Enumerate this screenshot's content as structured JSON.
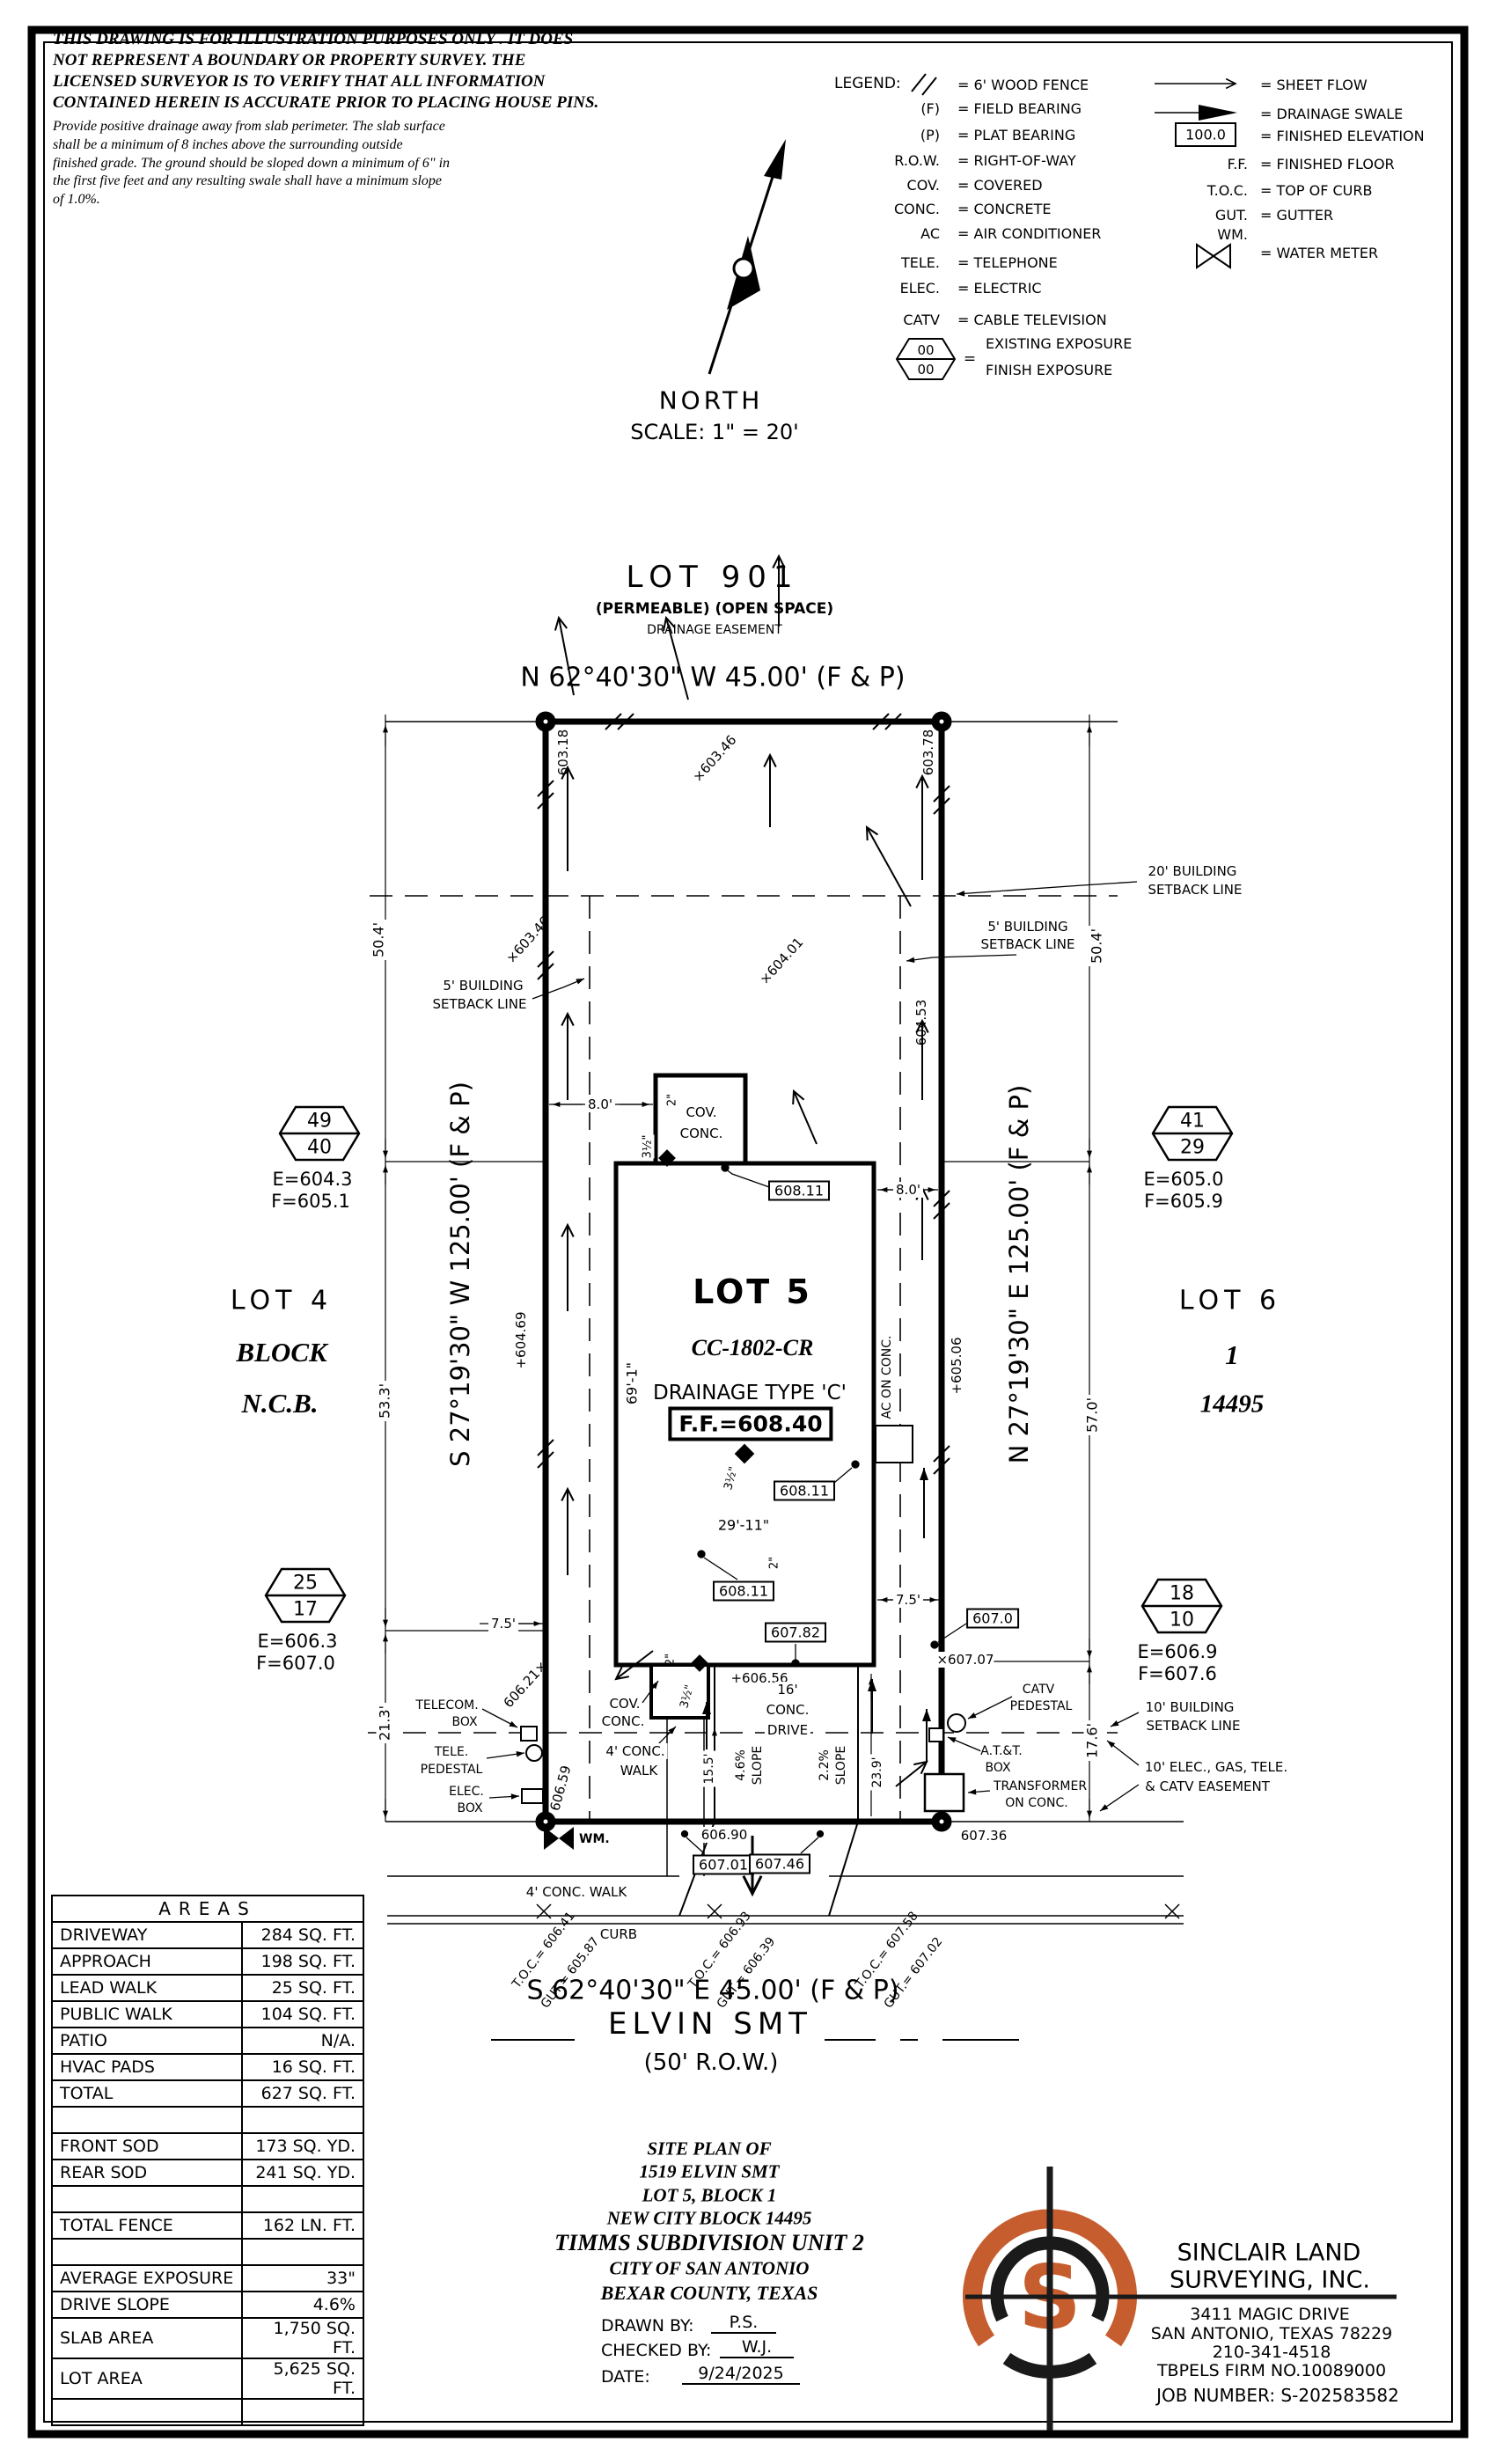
{
  "disclaimer": {
    "l1": "THIS DRAWING IS FOR ILLUSTRATION PURPOSES ONLY . IT DOES",
    "l2": "NOT REPRESENT A BOUNDARY OR PROPERTY SURVEY. THE",
    "l3": "LICENSED SURVEYOR IS TO VERIFY THAT ALL INFORMATION",
    "l4": "CONTAINED HEREIN IS ACCURATE PRIOR TO PLACING HOUSE PINS.",
    "note": "Provide positive drainage away from slab perimeter. The slab surface shall be a minimum of 8 inches above the surrounding outside finished grade. The ground should be sloped down a minimum of 6\" in the first five feet and any resulting swale shall have a minimum slope of 1.0%."
  },
  "legend": {
    "title": "LEGEND:",
    "eq": "=",
    "fence_def": "= 6' WOOD FENCE",
    "rows_left": [
      {
        "sym": "(F)",
        "def": "= FIELD BEARING"
      },
      {
        "sym": "(P)",
        "def": "= PLAT BEARING"
      },
      {
        "sym": "R.O.W.",
        "def": "= RIGHT-OF-WAY"
      },
      {
        "sym": "COV.",
        "def": "= COVERED"
      },
      {
        "sym": "CONC.",
        "def": "= CONCRETE"
      },
      {
        "sym": "AC",
        "def": "= AIR CONDITIONER"
      },
      {
        "sym": "TELE.",
        "def": "= TELEPHONE"
      },
      {
        "sym": "ELEC.",
        "def": "= ELECTRIC"
      },
      {
        "sym": "CATV",
        "def": "= CABLE TELEVISION"
      }
    ],
    "exposure": {
      "top": "00",
      "bottom": "00",
      "def1": "EXISTING EXPOSURE",
      "def2": "FINISH EXPOSURE"
    },
    "sheet_flow": "= SHEET FLOW",
    "swale": "= DRAINAGE SWALE",
    "fin_elev": {
      "sym": "100.0",
      "def": "= FINISHED ELEVATION"
    },
    "ff": {
      "sym": "F.F.",
      "def": "= FINISHED FLOOR"
    },
    "toc": {
      "sym": "T.O.C.",
      "def": "= TOP OF CURB"
    },
    "gut": {
      "sym": "GUT.",
      "def": "= GUTTER"
    },
    "wm": {
      "sym": "WM.",
      "def": "= WATER METER"
    }
  },
  "north": {
    "label": "NORTH",
    "scale": "SCALE: 1\" = 20'"
  },
  "plan": {
    "lot901": {
      "name": "LOT 901",
      "sub": "(PERMEABLE) (OPEN SPACE)",
      "sub2": "DRAINAGE EASEMENT"
    },
    "bearing_n": "N 62°40'30\" W 45.00' (F & P)",
    "bearing_s": "S 62°40'30\" E 45.00' (F & P)",
    "bearing_w": "S 27°19'30\" W 125.00' (F & P)",
    "bearing_e": "N 27°19'30\" E 125.00' (F & P)",
    "street": "ELVIN SMT",
    "row": "(50' R.O.W.)",
    "curb": "CURB",
    "lot4": {
      "a": "LOT 4",
      "b": "BLOCK",
      "c": "N.C.B."
    },
    "lot6": {
      "a": "LOT 6",
      "b": "1",
      "c": "14495"
    },
    "sb20a": "20' BUILDING",
    "sb20b": "SETBACK LINE",
    "sb5a": "5' BUILDING",
    "sb5b": "SETBACK LINE",
    "sb10a": "10' BUILDING",
    "sb10b": "SETBACK LINE",
    "easement1": "10' ELEC., GAS, TELE.",
    "easement2": "& CATV EASEMENT",
    "house": {
      "lot": "LOT 5",
      "plan_no": "CC-1802-CR",
      "pad": "+605.53",
      "drainage": "DRAINAGE TYPE 'C'",
      "ff": "F.F.=608.40"
    },
    "cov": "COV.",
    "conc": "CONC.",
    "drive1": "16'",
    "drive2": "CONC.",
    "drive3": "DRIVE",
    "walk1": "4' CONC.",
    "walk2": "WALK",
    "walk_street": "4' CONC. WALK",
    "ac": "AC ON CONC.",
    "wm": "WM.",
    "util": {
      "telecom1": "TELECOM.",
      "telecom2": "BOX",
      "tele1": "TELE.",
      "tele2": "PEDESTAL",
      "elec1": "ELEC.",
      "elec2": "BOX",
      "catv1": "CATV",
      "catv2": "PEDESTAL",
      "att1": "A.T.&T.",
      "att2": "BOX",
      "xfmr1": "TRANSFORMER",
      "xfmr2": "ON CONC."
    },
    "hex": [
      {
        "top": "49",
        "bot": "40",
        "e": "E=604.3",
        "f": "F=605.1"
      },
      {
        "top": "41",
        "bot": "29",
        "e": "E=605.0",
        "f": "F=605.9"
      },
      {
        "top": "25",
        "bot": "17",
        "e": "E=606.3",
        "f": "F=607.0"
      },
      {
        "top": "18",
        "bot": "10",
        "e": "E=606.9",
        "f": "F=607.6"
      }
    ],
    "spots": {
      "nw_corner": "603.18",
      "w_upper": "×603.46",
      "n_mid": "×603.46",
      "ne_corner": "603.78",
      "mid_upper": "×604.01",
      "e_upper": "604.53",
      "w_mid": "+604.69",
      "e_mid": "+605.06",
      "w_lower": "606.21×",
      "w_bottom": "606.59",
      "drive_top": "+606.56",
      "e_57line": "×607.07",
      "s_mid": "606.90",
      "se": "607.36"
    },
    "boxes": {
      "b1": "608.11",
      "b2": "608.11",
      "b3": "608.11",
      "b4": "607.82",
      "b5": "607.0",
      "b6": "607.01",
      "b7": "607.46"
    },
    "dims": {
      "left_top": "50.4'",
      "right_top": "50.4'",
      "left_mid": "53.3'",
      "right_mid": "57.0'",
      "left_bot": "21.3'",
      "right_bot": "17.6'",
      "w_gap": "8.0'",
      "e_gap": "8.0'",
      "house_h": "69'-1\"",
      "house_w": "29'-11\"",
      "porch2": "2\"",
      "porch35": "3½\"",
      "step2": "2\"",
      "step35": "3½\"",
      "stoop2": "2\"",
      "stoop35": "3½\"",
      "w75": "7.5'",
      "e75": "7.5'",
      "leadwalk": "15.5'",
      "drive_len": "23.9'",
      "slope1": "4.6%",
      "slope1b": "SLOPE",
      "slope2": "2.2%",
      "slope2b": "SLOPE"
    },
    "toc_groups": [
      {
        "t": "T.O.C.= 606.41",
        "g": "GUT.= 605.87"
      },
      {
        "t": "T.O.C.= 606.93",
        "g": "GUT.= 606.39"
      },
      {
        "t": "T.O.C.= 607.58",
        "g": "GUT.= 607.02"
      }
    ]
  },
  "areas": {
    "title": "AREAS",
    "rows": [
      [
        "DRIVEWAY",
        "284 SQ. FT."
      ],
      [
        "APPROACH",
        "198 SQ. FT."
      ],
      [
        "LEAD WALK",
        "25 SQ. FT."
      ],
      [
        "PUBLIC WALK",
        "104 SQ. FT."
      ],
      [
        "PATIO",
        "N/A."
      ],
      [
        "HVAC PADS",
        "16 SQ. FT."
      ],
      [
        "TOTAL",
        "627 SQ. FT."
      ],
      [
        "",
        ""
      ],
      [
        "FRONT SOD",
        "173 SQ. YD."
      ],
      [
        "REAR SOD",
        "241 SQ. YD."
      ],
      [
        "",
        ""
      ],
      [
        "TOTAL FENCE",
        "162 LN. FT."
      ],
      [
        "",
        ""
      ],
      [
        "AVERAGE EXPOSURE",
        "33\""
      ],
      [
        "DRIVE SLOPE",
        "4.6%"
      ],
      [
        "SLAB AREA",
        "1,750 SQ. FT."
      ],
      [
        "LOT AREA",
        "5,625 SQ. FT."
      ],
      [
        "",
        ""
      ]
    ]
  },
  "titleblock": {
    "l1": "SITE PLAN OF",
    "l2": "1519 ELVIN SMT",
    "l3": "LOT 5, BLOCK 1",
    "l4": "NEW CITY BLOCK 14495",
    "l5": "TIMMS SUBDIVISION UNIT 2",
    "l6": "CITY OF SAN ANTONIO",
    "l7": "BEXAR COUNTY, TEXAS",
    "drawn_label": "DRAWN BY:",
    "drawn": "P.S.",
    "checked_label": "CHECKED BY:",
    "checked": "W.J.",
    "date_label": "DATE:",
    "date": "9/24/2025"
  },
  "firm": {
    "logo_letter": "S",
    "logo_orange": "#c65d2e",
    "name1": "SINCLAIR LAND",
    "name2": "SURVEYING, INC.",
    "addr1": "3411 MAGIC DRIVE",
    "addr2": "SAN ANTONIO, TEXAS 78229",
    "phone": "210-341-4518",
    "reg": "TBPELS FIRM NO.10089000",
    "job": "JOB NUMBER: S-202583582"
  }
}
